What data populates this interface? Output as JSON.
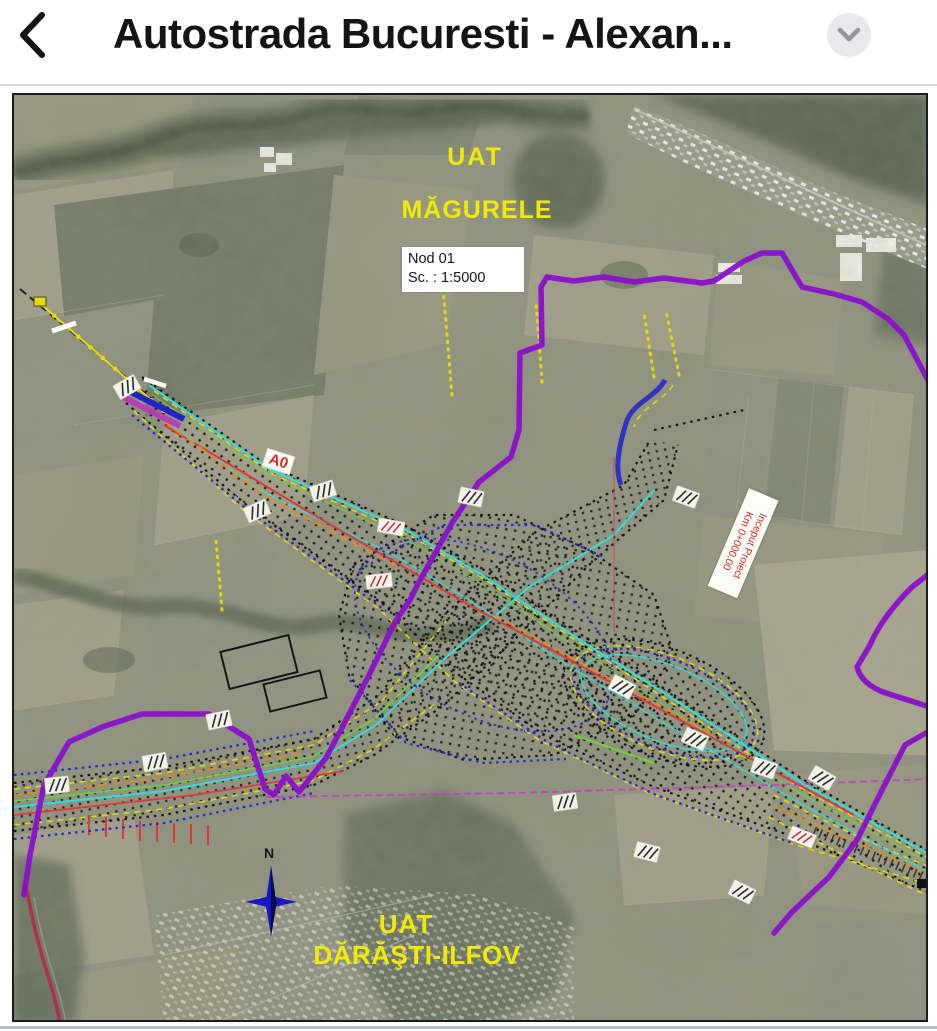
{
  "header": {
    "title": "Autostrada Bucuresti - Alexan...",
    "back_icon": "chevron-left",
    "menu_icon": "chevron-down"
  },
  "map": {
    "labels": {
      "uat_magurele_line1": "UAT",
      "uat_magurele_line2": "MĂGURELE",
      "uat_darasti_line1": "UAT",
      "uat_darasti_line2": "DĂRĂŞTI-ILFOV",
      "node_box_line1": "Nod 01",
      "node_box_line2": "Sc. : 1:5000",
      "road_label": "A0",
      "project_start_line1": "Inceput Proiect",
      "project_start_line2": "Km 0+000.00",
      "compass": "N"
    },
    "scale": "1:5000",
    "node_name": "Nod 01"
  },
  "colors": {
    "header_bg": "#ffffff",
    "header_text": "#141414",
    "header_divider": "#d8d8dc",
    "chip_bg": "#e9e9eb",
    "chip_icon": "#96969c",
    "page_bg": "#ffffff",
    "map_border": "#1c1c1c",
    "terrain_base": "#8e907d",
    "forest": "#515e4b",
    "river": "#46523f",
    "label_yellow": "#f2ea00",
    "label_red": "#d42b1e",
    "boundary_purple": "#8a10cc",
    "line_magenta": "#cc33cc",
    "line_cyan": "#35dcd8",
    "line_green": "#6fd23a",
    "line_yellow": "#e9da00",
    "line_orange": "#e08c1e",
    "line_red": "#dd3a3a",
    "line_blue": "#2a2ac8",
    "stake_black": "#0d0d0d",
    "crimson_road": "#b03050",
    "bottom_bar": "#b7bec6"
  }
}
